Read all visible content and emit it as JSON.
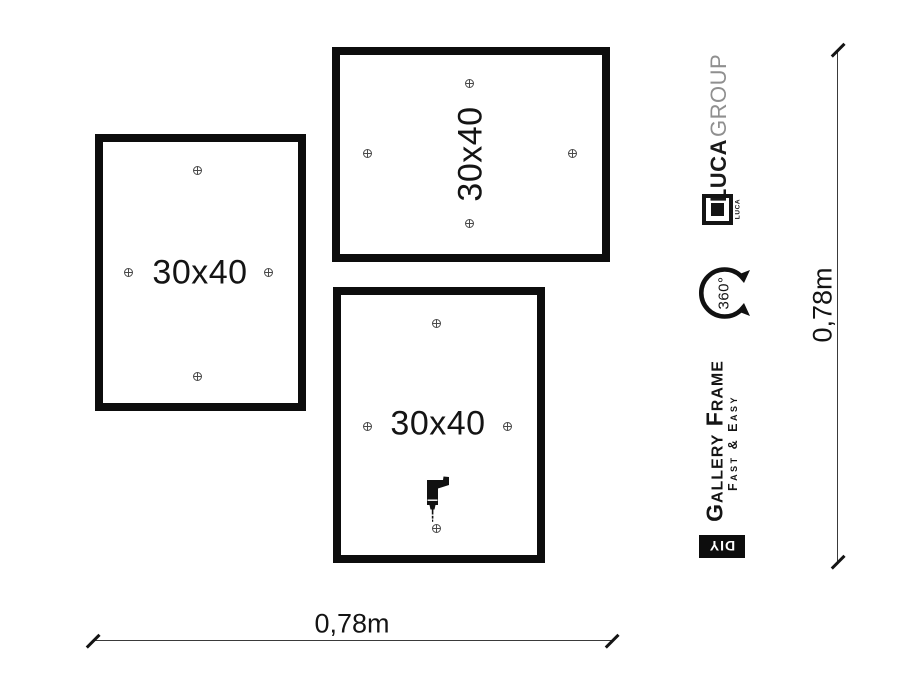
{
  "frames": [
    {
      "id": "left",
      "label": "30x40"
    },
    {
      "id": "top",
      "label": "30x40"
    },
    {
      "id": "bottom",
      "label": "30x40"
    }
  ],
  "dimensions": {
    "width_label": "0,78m",
    "height_label": "0,78m"
  },
  "branding": {
    "brand_primary": "LUCA",
    "brand_secondary": "GROUP",
    "logo_caption": "LUCA",
    "rotation_badge": "360°",
    "product_name": "Gallery Frame",
    "tagline": "Fast & Easy",
    "diy_badge": "DIY"
  },
  "icons": {
    "mount_point": "crosshair-circle-marker",
    "drill": "power-drill",
    "rotation": "360-degree-circular-arrow",
    "logo_mark": "luca-square-frame-logo"
  },
  "colors": {
    "frame_border": "#0d0d0d",
    "marker": "#4a4a4a",
    "brand_secondary_gray": "#8f8f8f",
    "dimension_line": "#3a3a3a",
    "background": "#ffffff"
  }
}
